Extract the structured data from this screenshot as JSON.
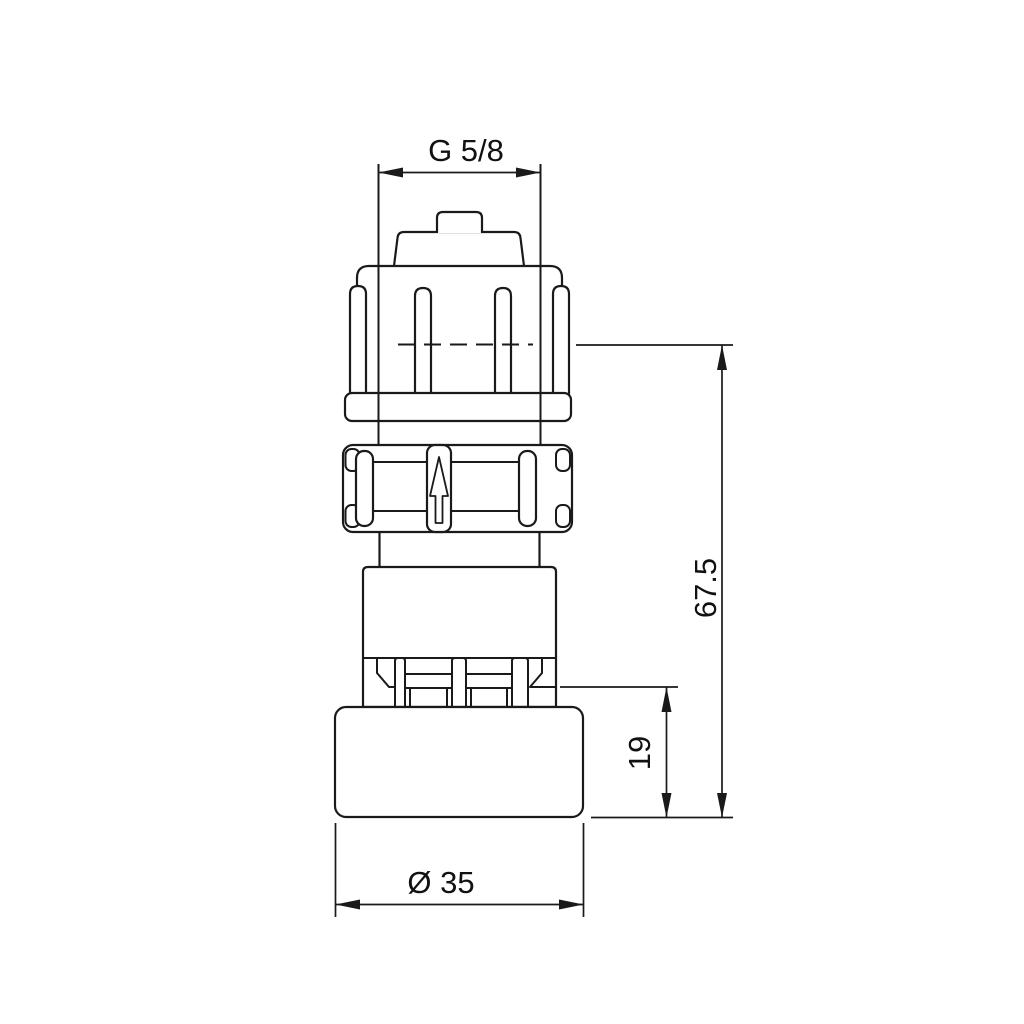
{
  "page": {
    "background": "#ffffff",
    "line_color": "#1a1a1a"
  },
  "drawing": {
    "type": "technical-drawing-connector-fitting",
    "dimensions": {
      "thread": "G 5/8",
      "overall_height": "67.5",
      "lower_height": "19",
      "diameter": "Ø 35"
    }
  }
}
